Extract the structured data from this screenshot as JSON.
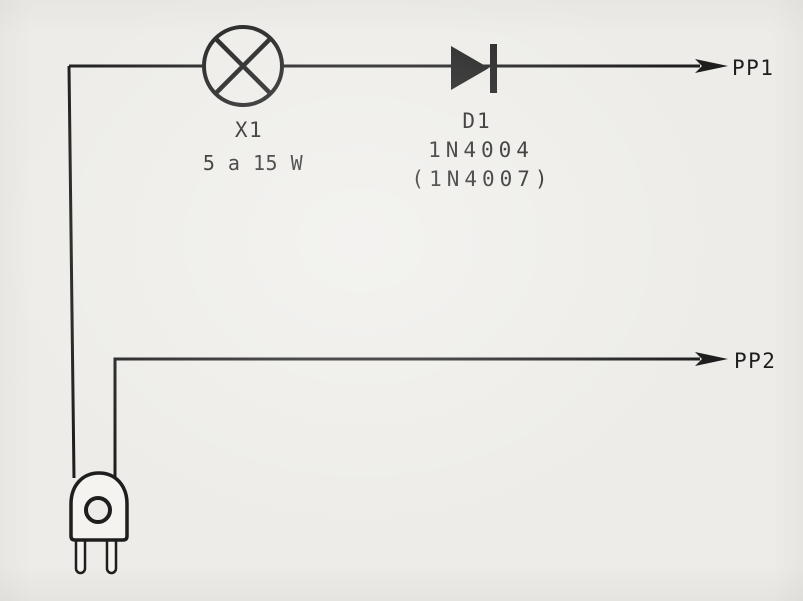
{
  "colors": {
    "paper": "#edecE8",
    "ink": "#1e1e1e",
    "plug_fill": "#f4f3ef"
  },
  "components": {
    "lamp": {
      "symbol": "lamp-icon",
      "ref": "X1",
      "rating": "5 a 15 W"
    },
    "diode": {
      "symbol": "diode-icon",
      "ref": "D1",
      "part": "1N4004",
      "alt_part": "(1N4007)"
    },
    "plug": {
      "symbol": "ac-plug-icon"
    },
    "outputs": {
      "pp1": "PP1",
      "pp2": "PP2"
    }
  }
}
